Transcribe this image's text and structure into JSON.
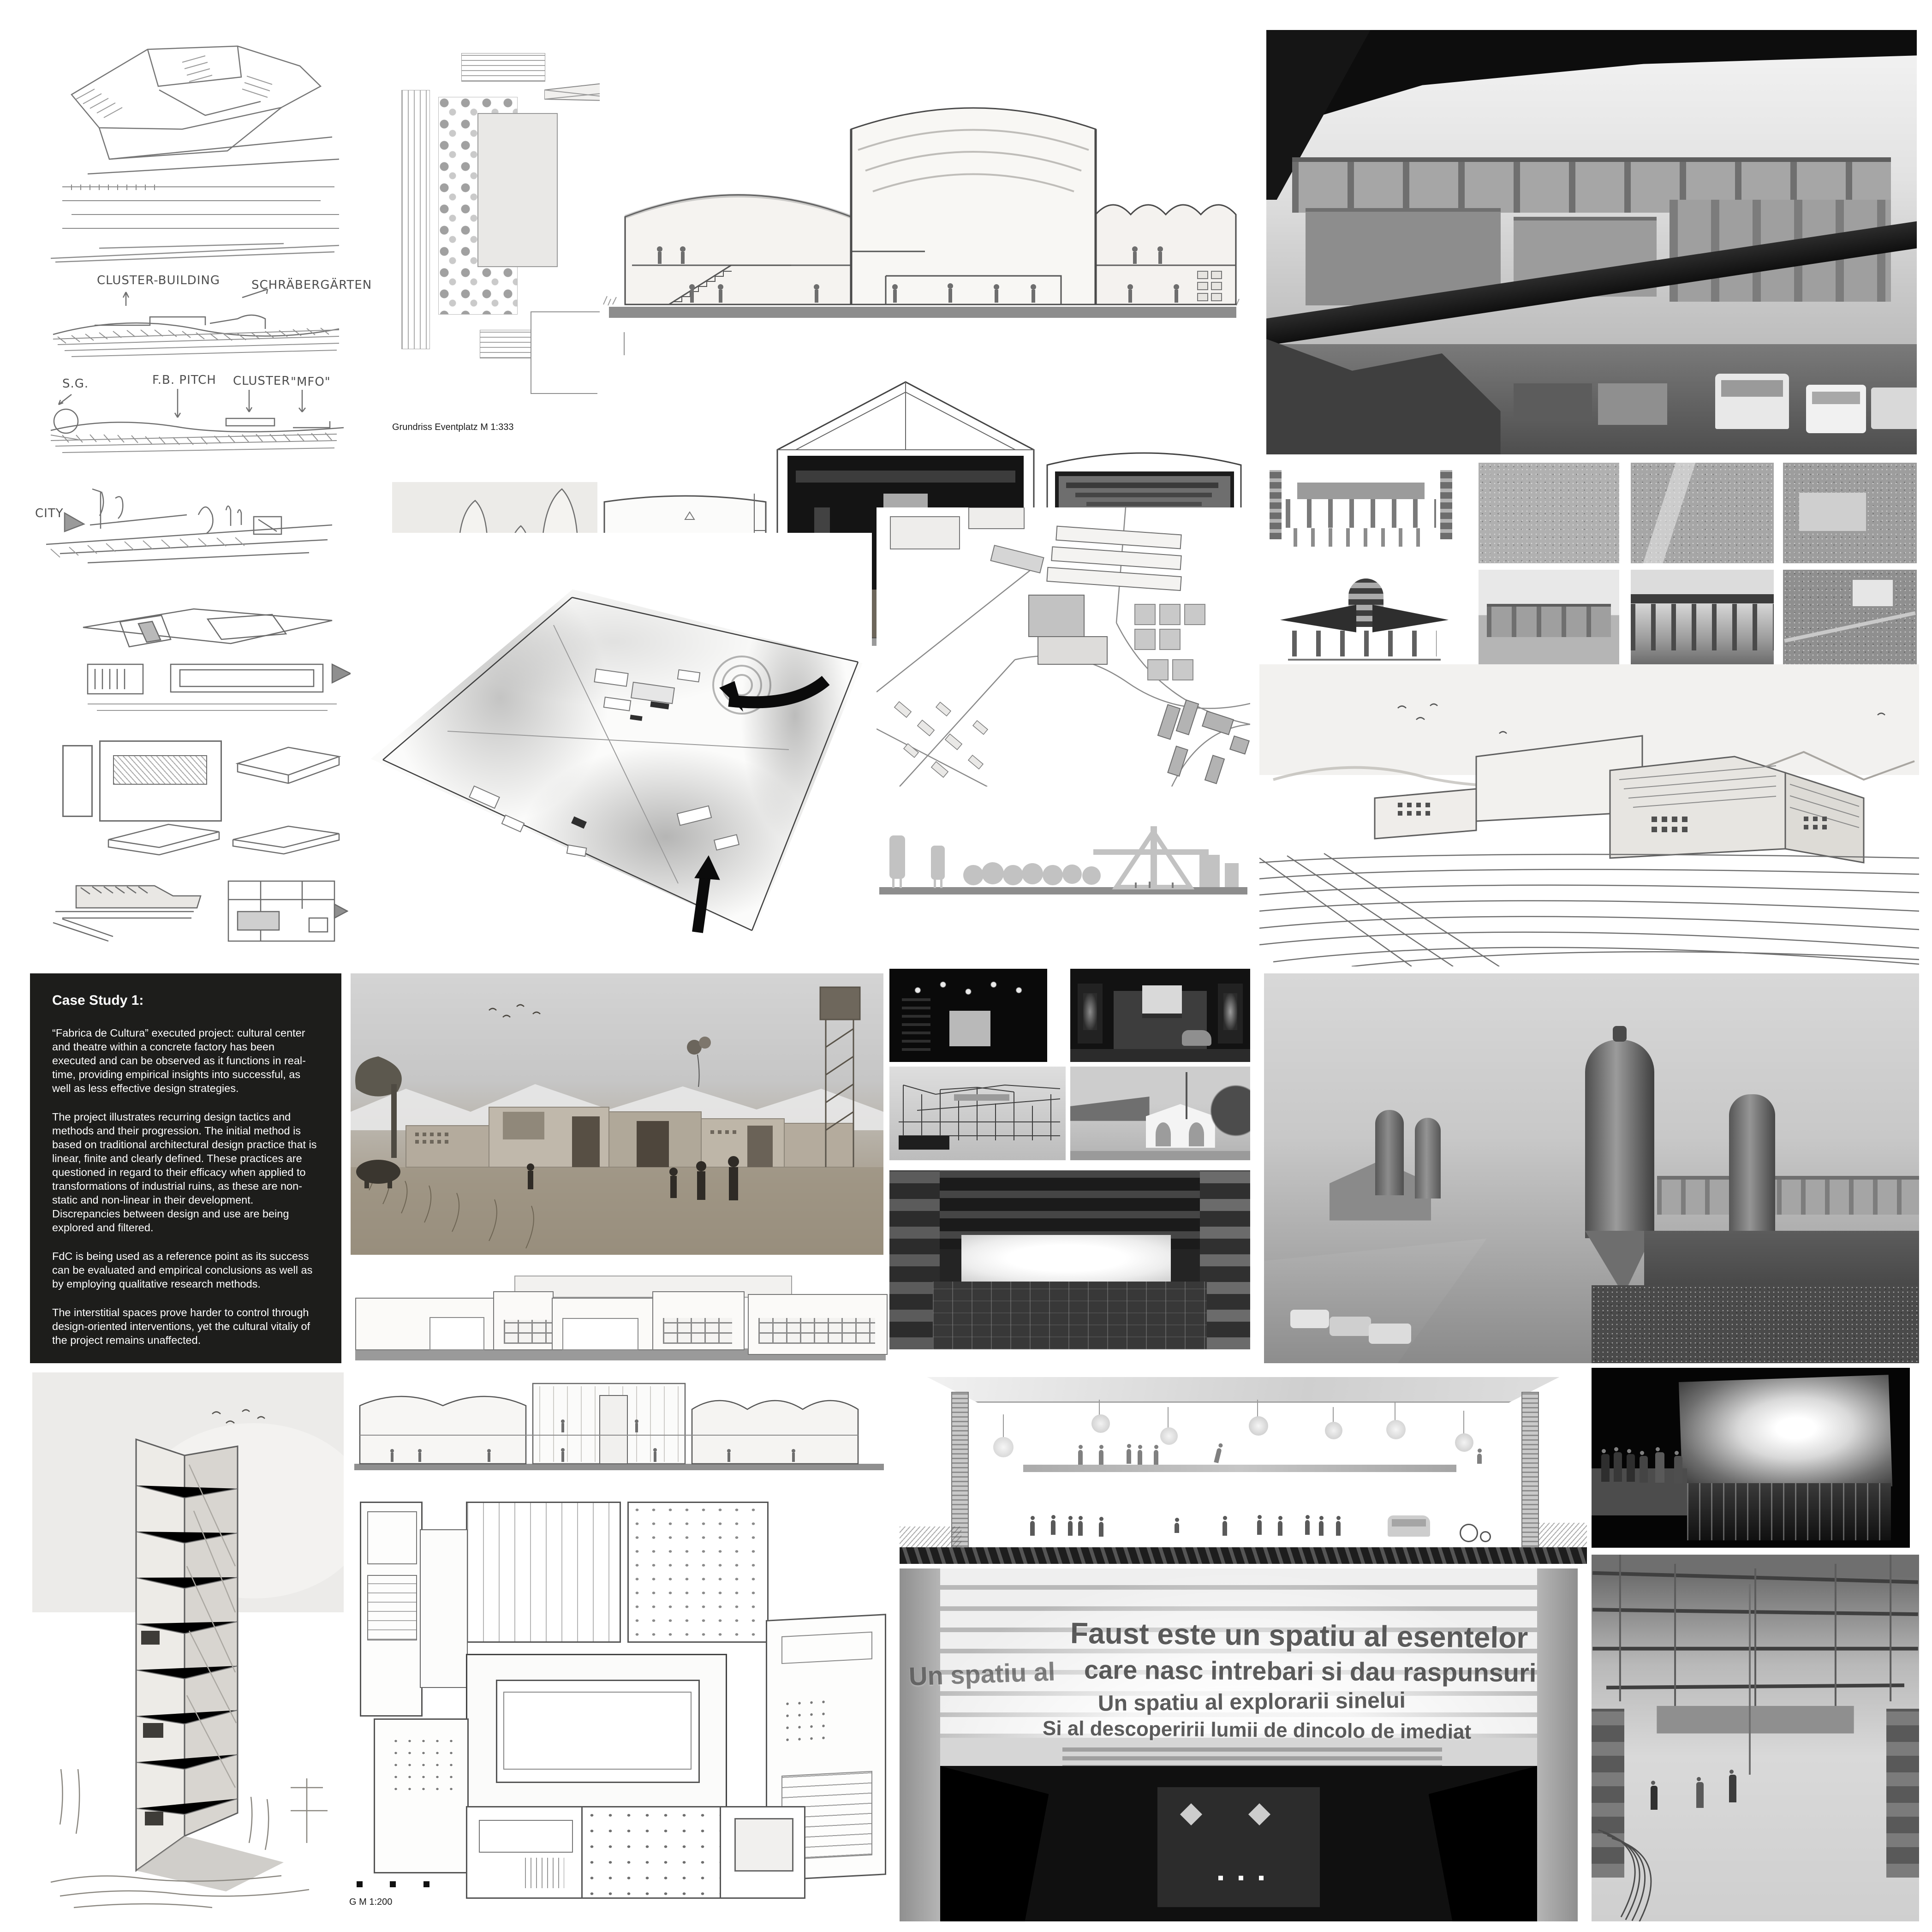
{
  "case_study": {
    "title": "Case Study 1:",
    "paragraphs": [
      "“Fabrica de Cultura” executed project: cultural center and theatre within a concrete factory has been executed and can be observed as it functions in real-time, providing empirical insights into successful, as well as less effective design strategies.",
      "The project illustrates recurring design tactics and methods and their progression. The initial method is based on traditional architectural design practice that is linear, finite and clearly defined. These practices are questioned in regard to their efficacy when applied to transformations of industrial ruins, as these are non-static and non-linear in their development. Discrepancies between design and use are being explored and filtered.",
      "FdC is being used as a reference point as its success can be evaluated and empirical conclusions as well as by employing qualitative research methods.",
      "The interstitial spaces prove harder to control through design-oriented interventions, yet the cultural vitaliy of the project remains unaffected."
    ]
  },
  "captions": {
    "garden_plan": "Grundriss Eventplatz M 1:333",
    "floor_plan": "G M 1:200"
  },
  "sketch_labels": {
    "cluster_building": "CLUSTER-BUILDING",
    "allotments": "SCHRÄBERGÄRTEN",
    "sg": "S.G.",
    "fb_pitch": "F.B. PITCH",
    "cluster": "CLUSTER",
    "mfo": "\"MFO\"",
    "city": "CITY"
  },
  "stage_text": {
    "line1": "Faust este un spatiu al esentelor",
    "line2_prefix": "Un spatiu al",
    "line2": "care nasc intrebari si dau raspunsuri",
    "line3": "Un spatiu al explorarii sinelui",
    "line4": "Si al descoperirii lumii de dincolo de imediat"
  },
  "colors": {
    "text_panel_bg": "#1d1d1b",
    "text_panel_fg": "#ffffff",
    "sketch_stroke": "#777777",
    "photo_dark": "#111111",
    "ground_gray": "#8f8f8f"
  }
}
